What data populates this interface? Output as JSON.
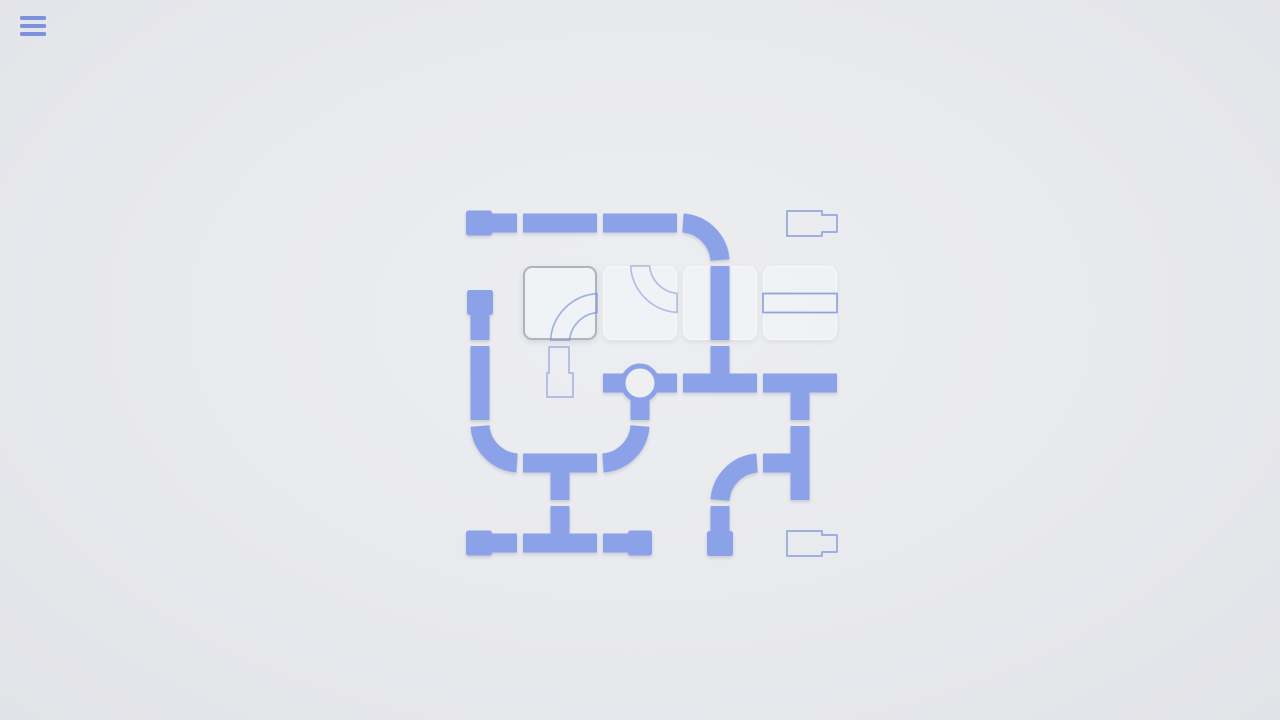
{
  "app": {
    "name": "pipes-puzzle-game"
  },
  "menu": {
    "icon": "hamburger-menu-icon"
  },
  "colors": {
    "background": "#E8E9ED",
    "pipe": "#8CA2E8",
    "ghost_pipe": "#7E96D8",
    "cell_fill": "#F0F2F5",
    "selected_cell_border": "#B0B3BB",
    "menu_icon": "#7C92DC",
    "valve_inner": "#EDEFF3"
  },
  "board": {
    "rows": 5,
    "cols": 5,
    "tray_cells": [
      {
        "col": 1,
        "row": 1,
        "selected": true
      },
      {
        "col": 2,
        "row": 1,
        "selected": false
      },
      {
        "col": 3,
        "row": 1,
        "selected": false
      },
      {
        "col": 4,
        "row": 1,
        "selected": false
      }
    ],
    "pieces": [
      {
        "col": 0,
        "row": 0,
        "kind": "end",
        "conn": "r",
        "ghost": false
      },
      {
        "col": 1,
        "row": 0,
        "kind": "straight",
        "conn": "lr",
        "ghost": false
      },
      {
        "col": 2,
        "row": 0,
        "kind": "straight",
        "conn": "lr",
        "ghost": false
      },
      {
        "col": 3,
        "row": 0,
        "kind": "elbow",
        "conn": "ld",
        "ghost": false
      },
      {
        "col": 4,
        "row": 0,
        "kind": "end",
        "conn": "r",
        "ghost": true,
        "alpha": 0.8
      },
      {
        "col": 0,
        "row": 1,
        "kind": "end",
        "conn": "d",
        "ghost": false
      },
      {
        "col": 1,
        "row": 1,
        "kind": "elbow",
        "conn": "rd",
        "ghost": true,
        "alpha": 0.7
      },
      {
        "col": 2,
        "row": 1,
        "kind": "elbow",
        "conn": "ur",
        "ghost": true,
        "alpha": 0.55
      },
      {
        "col": 3,
        "row": 1,
        "kind": "straight",
        "conn": "ud",
        "ghost": false
      },
      {
        "col": 4,
        "row": 1,
        "kind": "straight",
        "conn": "lr",
        "ghost": true,
        "alpha": 0.85
      },
      {
        "col": 0,
        "row": 2,
        "kind": "straight",
        "conn": "ud",
        "ghost": false
      },
      {
        "col": 1,
        "row": 2,
        "kind": "end",
        "conn": "u",
        "ghost": true,
        "alpha": 0.6
      },
      {
        "col": 2,
        "row": 2,
        "kind": "valve",
        "conn": "lrd",
        "ghost": false
      },
      {
        "col": 3,
        "row": 2,
        "kind": "tee",
        "conn": "ulr",
        "ghost": false
      },
      {
        "col": 4,
        "row": 2,
        "kind": "tee",
        "conn": "lrd",
        "ghost": false
      },
      {
        "col": 0,
        "row": 3,
        "kind": "elbow",
        "conn": "ur",
        "ghost": false
      },
      {
        "col": 1,
        "row": 3,
        "kind": "tee",
        "conn": "lrd",
        "ghost": false
      },
      {
        "col": 2,
        "row": 3,
        "kind": "elbow",
        "conn": "ul",
        "ghost": false
      },
      {
        "col": 3,
        "row": 3,
        "kind": "elbow",
        "conn": "rd",
        "ghost": false
      },
      {
        "col": 4,
        "row": 3,
        "kind": "tee",
        "conn": "udl",
        "ghost": false
      },
      {
        "col": 0,
        "row": 4,
        "kind": "end",
        "conn": "r",
        "ghost": false
      },
      {
        "col": 1,
        "row": 4,
        "kind": "tee",
        "conn": "ulr",
        "ghost": false
      },
      {
        "col": 2,
        "row": 4,
        "kind": "end",
        "conn": "l",
        "ghost": false
      },
      {
        "col": 3,
        "row": 4,
        "kind": "end",
        "conn": "u",
        "ghost": false
      },
      {
        "col": 4,
        "row": 4,
        "kind": "end",
        "conn": "r",
        "ghost": true,
        "alpha": 0.8
      }
    ]
  }
}
